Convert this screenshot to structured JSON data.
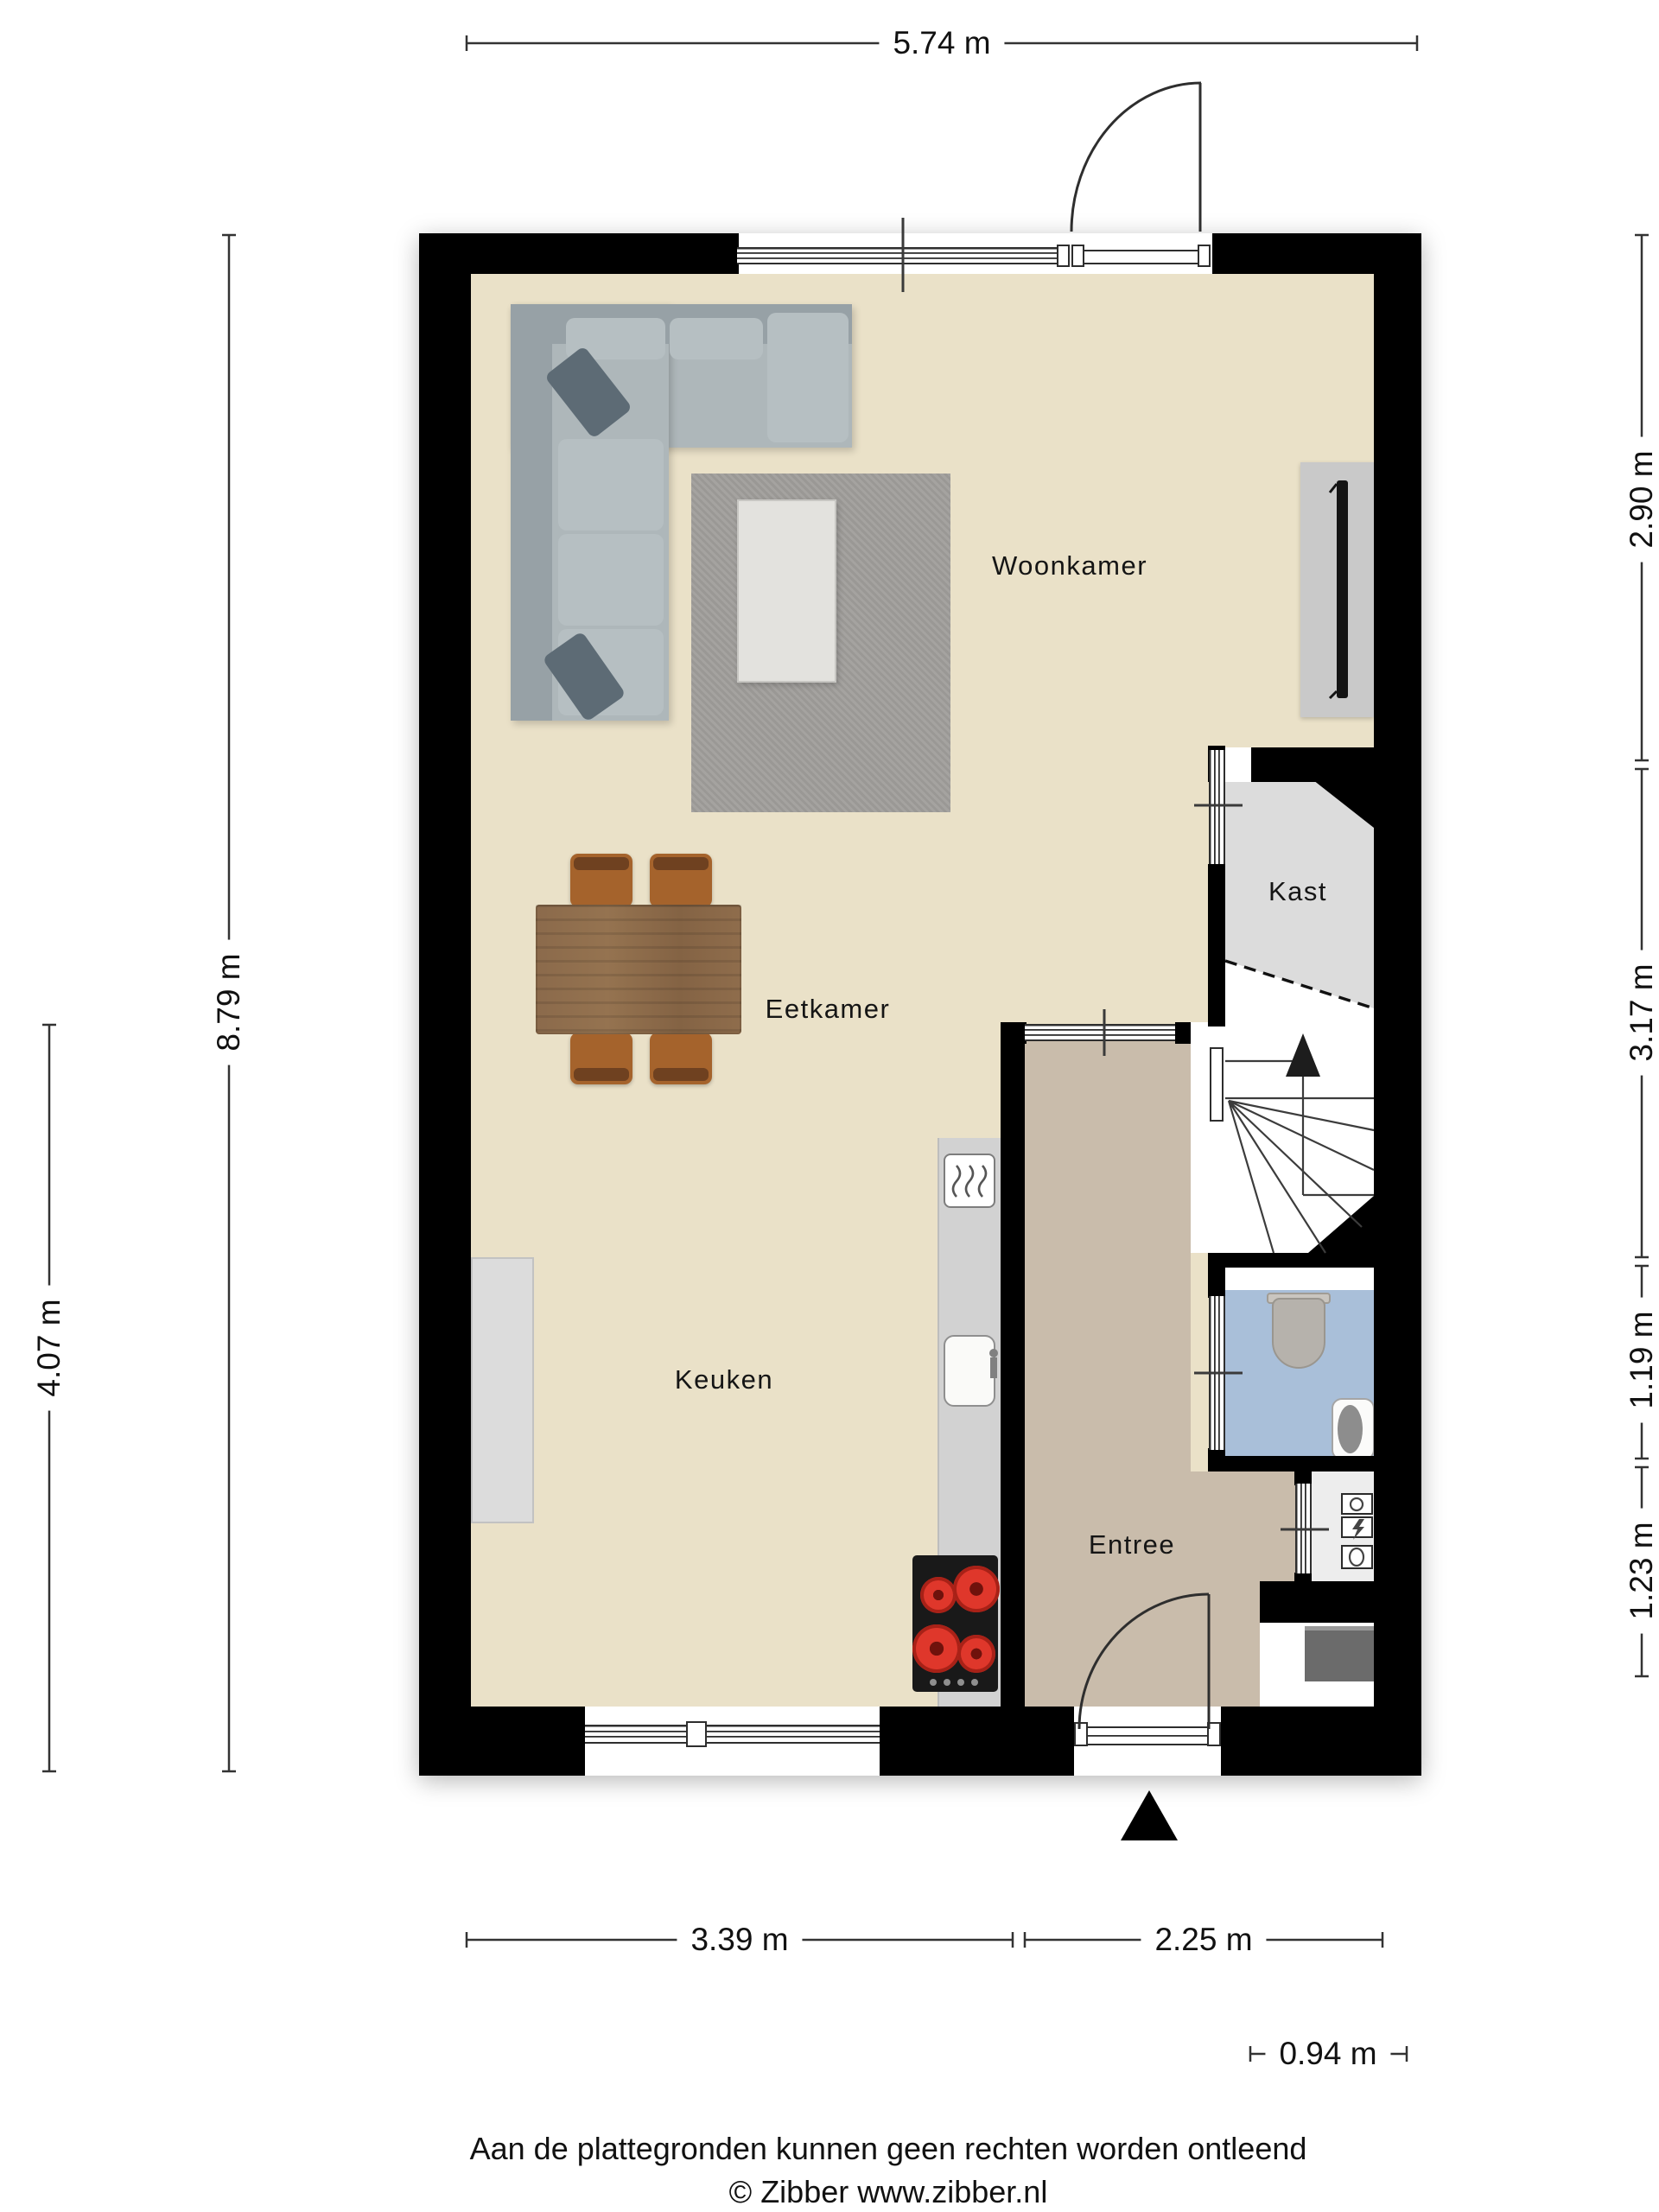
{
  "plan": {
    "rooms": {
      "woonkamer": "Woonkamer",
      "eetkamer": "Eetkamer",
      "keuken": "Keuken",
      "kast": "Kast",
      "entree": "Entree"
    },
    "colors": {
      "wall": "#000000",
      "floor_main": "#eae1c8",
      "floor_entree": "#c9bcab",
      "floor_toilet": "#a9bfd9",
      "floor_kast": "#dcdcdc",
      "floor_meterkast": "#ededed",
      "stove_burner": "#df372b",
      "sofa": "#aeb7ba",
      "dining_wood": "#8b6a4b"
    }
  },
  "dimensions": {
    "top": "5.74 m",
    "left_inner": "8.79 m",
    "left_outer": "4.07 m",
    "right_1": "2.90 m",
    "right_2": "3.17 m",
    "right_3": "1.19 m",
    "right_4": "1.23 m",
    "bottom_1": "3.39 m",
    "bottom_2": "2.25 m",
    "bottom_3": "0.94 m"
  },
  "footer": {
    "line1": "Aan de plattegronden kunnen geen rechten worden ontleend",
    "line2": "© Zibber www.zibber.nl"
  }
}
